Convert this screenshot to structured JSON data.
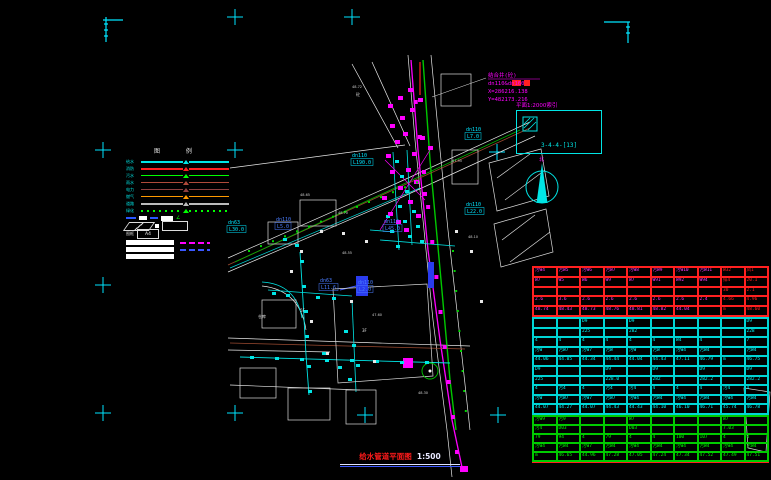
{
  "drawing": {
    "title": {
      "name": "给水管道平面图",
      "scale": "1:500"
    },
    "detail_box": {
      "header": "平面1:2000索引",
      "code": "3-4-4-[13]"
    },
    "north_label": "北",
    "annotation": {
      "lines": [
        "结合井(砼)",
        "dn110&dn160",
        "X=286216.138",
        "Y=482173.216"
      ]
    },
    "pipe_labels": [
      {
        "x": 352,
        "y": 157,
        "d": "dn110",
        "l": "L190.0",
        "c": "#00e5ff"
      },
      {
        "x": 228,
        "y": 224,
        "d": "dn63",
        "l": "L30.0",
        "c": "#00e5ff"
      },
      {
        "x": 276,
        "y": 221,
        "d": "dn110",
        "l": "L5.0",
        "c": "#4a7dff"
      },
      {
        "x": 384,
        "y": 223,
        "d": "dn110",
        "l": "L45.0",
        "c": "#4a7dff"
      },
      {
        "x": 466,
        "y": 131,
        "d": "dn110",
        "l": "L7.0",
        "c": "#00e5ff"
      },
      {
        "x": 466,
        "y": 206,
        "d": "dn110",
        "l": "L22.0",
        "c": "#00e5ff"
      },
      {
        "x": 320,
        "y": 282,
        "d": "dn63",
        "l": "L11.6",
        "c": "#4a7dff"
      },
      {
        "x": 358,
        "y": 284,
        "d": "dn110",
        "l": "L2.0",
        "c": "#4a7dff"
      }
    ],
    "spot_elevations": [
      {
        "x": 352,
        "y": 88,
        "v": "48.72"
      },
      {
        "x": 300,
        "y": 196,
        "v": "48.65"
      },
      {
        "x": 338,
        "y": 214,
        "v": "48.70"
      },
      {
        "x": 452,
        "y": 162,
        "v": "47.95"
      },
      {
        "x": 468,
        "y": 238,
        "v": "48.10"
      },
      {
        "x": 342,
        "y": 254,
        "v": "48.55"
      },
      {
        "x": 372,
        "y": 316,
        "v": "47.60"
      },
      {
        "x": 418,
        "y": 394,
        "v": "48.30"
      }
    ],
    "misc_labels": [
      {
        "x": 356,
        "y": 96,
        "t": "砼"
      },
      {
        "x": 258,
        "y": 318,
        "t": "仓库"
      },
      {
        "x": 300,
        "y": 312,
        "t": "5F"
      },
      {
        "x": 362,
        "y": 332,
        "t": "3F"
      }
    ],
    "frame": {
      "crosses": [
        {
          "x": 235,
          "y": 17
        },
        {
          "x": 352,
          "y": 17
        },
        {
          "x": 103,
          "y": 150
        },
        {
          "x": 235,
          "y": 150
        },
        {
          "x": 497,
          "y": 152
        },
        {
          "x": 103,
          "y": 285
        },
        {
          "x": 103,
          "y": 413
        },
        {
          "x": 235,
          "y": 413
        },
        {
          "x": 365,
          "y": 415
        },
        {
          "x": 498,
          "y": 415
        }
      ]
    }
  },
  "legend": {
    "header": "图 例",
    "items": [
      {
        "label": "给水",
        "color": "#00e5e5",
        "style": "solid",
        "thick": true
      },
      {
        "label": "消防",
        "color": "#ff2020",
        "style": "solid",
        "thick": true
      },
      {
        "label": "污水",
        "color": "#00ff00",
        "style": "solid",
        "thick": false
      },
      {
        "label": "雨水",
        "color": "#b04a3a",
        "style": "solid",
        "thick": false
      },
      {
        "label": "电力",
        "color": "#8f4040",
        "style": "solid",
        "thick": false
      },
      {
        "label": "燃气",
        "color": "#ff9900",
        "style": "solid",
        "thick": false
      },
      {
        "label": "道路",
        "color": "#bbbbbb",
        "style": "solid",
        "thick": true
      },
      {
        "label": "绿化",
        "color": "#00ff00",
        "style": "dotted",
        "thick": true
      }
    ],
    "frame_row": {
      "label": "图框",
      "box": "A4"
    }
  },
  "table": {
    "bands": [
      {
        "border": "#ff2020",
        "text": "#ff3aff",
        "alt_text": "#ff2020",
        "alt_from": 8,
        "row_h": 7.8,
        "rows": [
          [
            "污W4",
            "污W5",
            "污W6",
            "污W7",
            "污W8",
            "污W9",
            "污W10",
            "污W11",
            "W32",
            "凤1"
          ],
          [
            "W7",
            "W5",
            "W6",
            "W9",
            "W7",
            "W91",
            "W92",
            "W94",
            "排4",
            "20.1"
          ],
          [
            "",
            "",
            "",
            "",
            "",
            "",
            "",
            "",
            "30",
            "2.1"
          ],
          [
            "2.6",
            "3.6",
            "2.6",
            "2.6",
            "2.6",
            "2.6",
            "2.6",
            "2.4",
            "4.66",
            "4.96"
          ],
          [
            "48.74",
            "48.43",
            "48.73",
            "48.76",
            "48.81",
            "48.82",
            "44.04",
            "",
            "m",
            "48.60"
          ]
        ]
      },
      {
        "border": "#00d5d5",
        "text": "#00ffff",
        "alt_text": "#00ffff",
        "alt_from": 10,
        "row_h": 7.6,
        "rows": [
          [
            "",
            "",
            "D9",
            "",
            "D9",
            "",
            "",
            "",
            "",
            "D9"
          ],
          [
            "",
            "",
            "225",
            "",
            "282",
            "",
            "",
            "",
            "",
            "228"
          ],
          [
            "4",
            "4",
            "4",
            "4",
            "4",
            "4",
            "W4",
            "4",
            "",
            "7"
          ],
          [
            "污W",
            "污W7",
            "污W7",
            "污W",
            "污W",
            "污W",
            "污W4",
            "污W4",
            "",
            "污W4"
          ],
          [
            "44.06",
            "44.05",
            "44.34",
            "44.44",
            "44.04",
            "44.43",
            "47.11",
            "46.79",
            "m",
            "46.75"
          ],
          [
            "D9",
            "",
            "",
            "D9",
            "",
            "D9",
            "",
            "D9",
            "",
            "D9"
          ],
          [
            "225",
            "",
            "",
            "228.0",
            "",
            "282",
            "",
            "282.2",
            "",
            "282.2"
          ],
          [
            "4",
            "污4",
            "4",
            "污4",
            "污4",
            "4",
            "4",
            "4",
            "污4",
            "4"
          ],
          [
            "污W",
            "污W7",
            "污W7",
            "污W7",
            "污W4",
            "污W4",
            "污W4",
            "污W4",
            "污W4",
            "污W4"
          ],
          [
            "44.07",
            "44.27",
            "44.07",
            "44.43",
            "44.43",
            "44.10",
            "46.10",
            "46.71",
            "45.74",
            "46.78"
          ]
        ]
      },
      {
        "border": "#00cc00",
        "text": "#00ff00",
        "alt_text": "#00ff00",
        "alt_from": 10,
        "row_h": 7.0,
        "rows": [
          [
            "污W9",
            "污9",
            "",
            "",
            "W7",
            "",
            "",
            "",
            "W7",
            ""
          ],
          [
            "污4",
            "D03",
            "",
            "",
            "D03",
            "",
            "",
            "",
            "7.03",
            ""
          ],
          [
            "79",
            "94",
            "4",
            "79",
            "4",
            "4",
            "100",
            "107",
            "4",
            "4"
          ],
          [
            "污W4",
            "污W4",
            "污W7",
            "污W4",
            "污W4",
            "污W4",
            "污W4",
            "污W4",
            "污W4",
            "污W4"
          ],
          [
            "m",
            "46.65",
            "44.96",
            "47.28",
            "47.05",
            "47.24",
            "47.34",
            "47.52",
            "47.49",
            "47.51"
          ]
        ]
      }
    ]
  },
  "colors": {
    "frame_cross": "#00e5ff",
    "water": "#00e5e5",
    "sewer": "#ff00ff",
    "green_line": "#00d400",
    "road": "#e8e8e8"
  }
}
